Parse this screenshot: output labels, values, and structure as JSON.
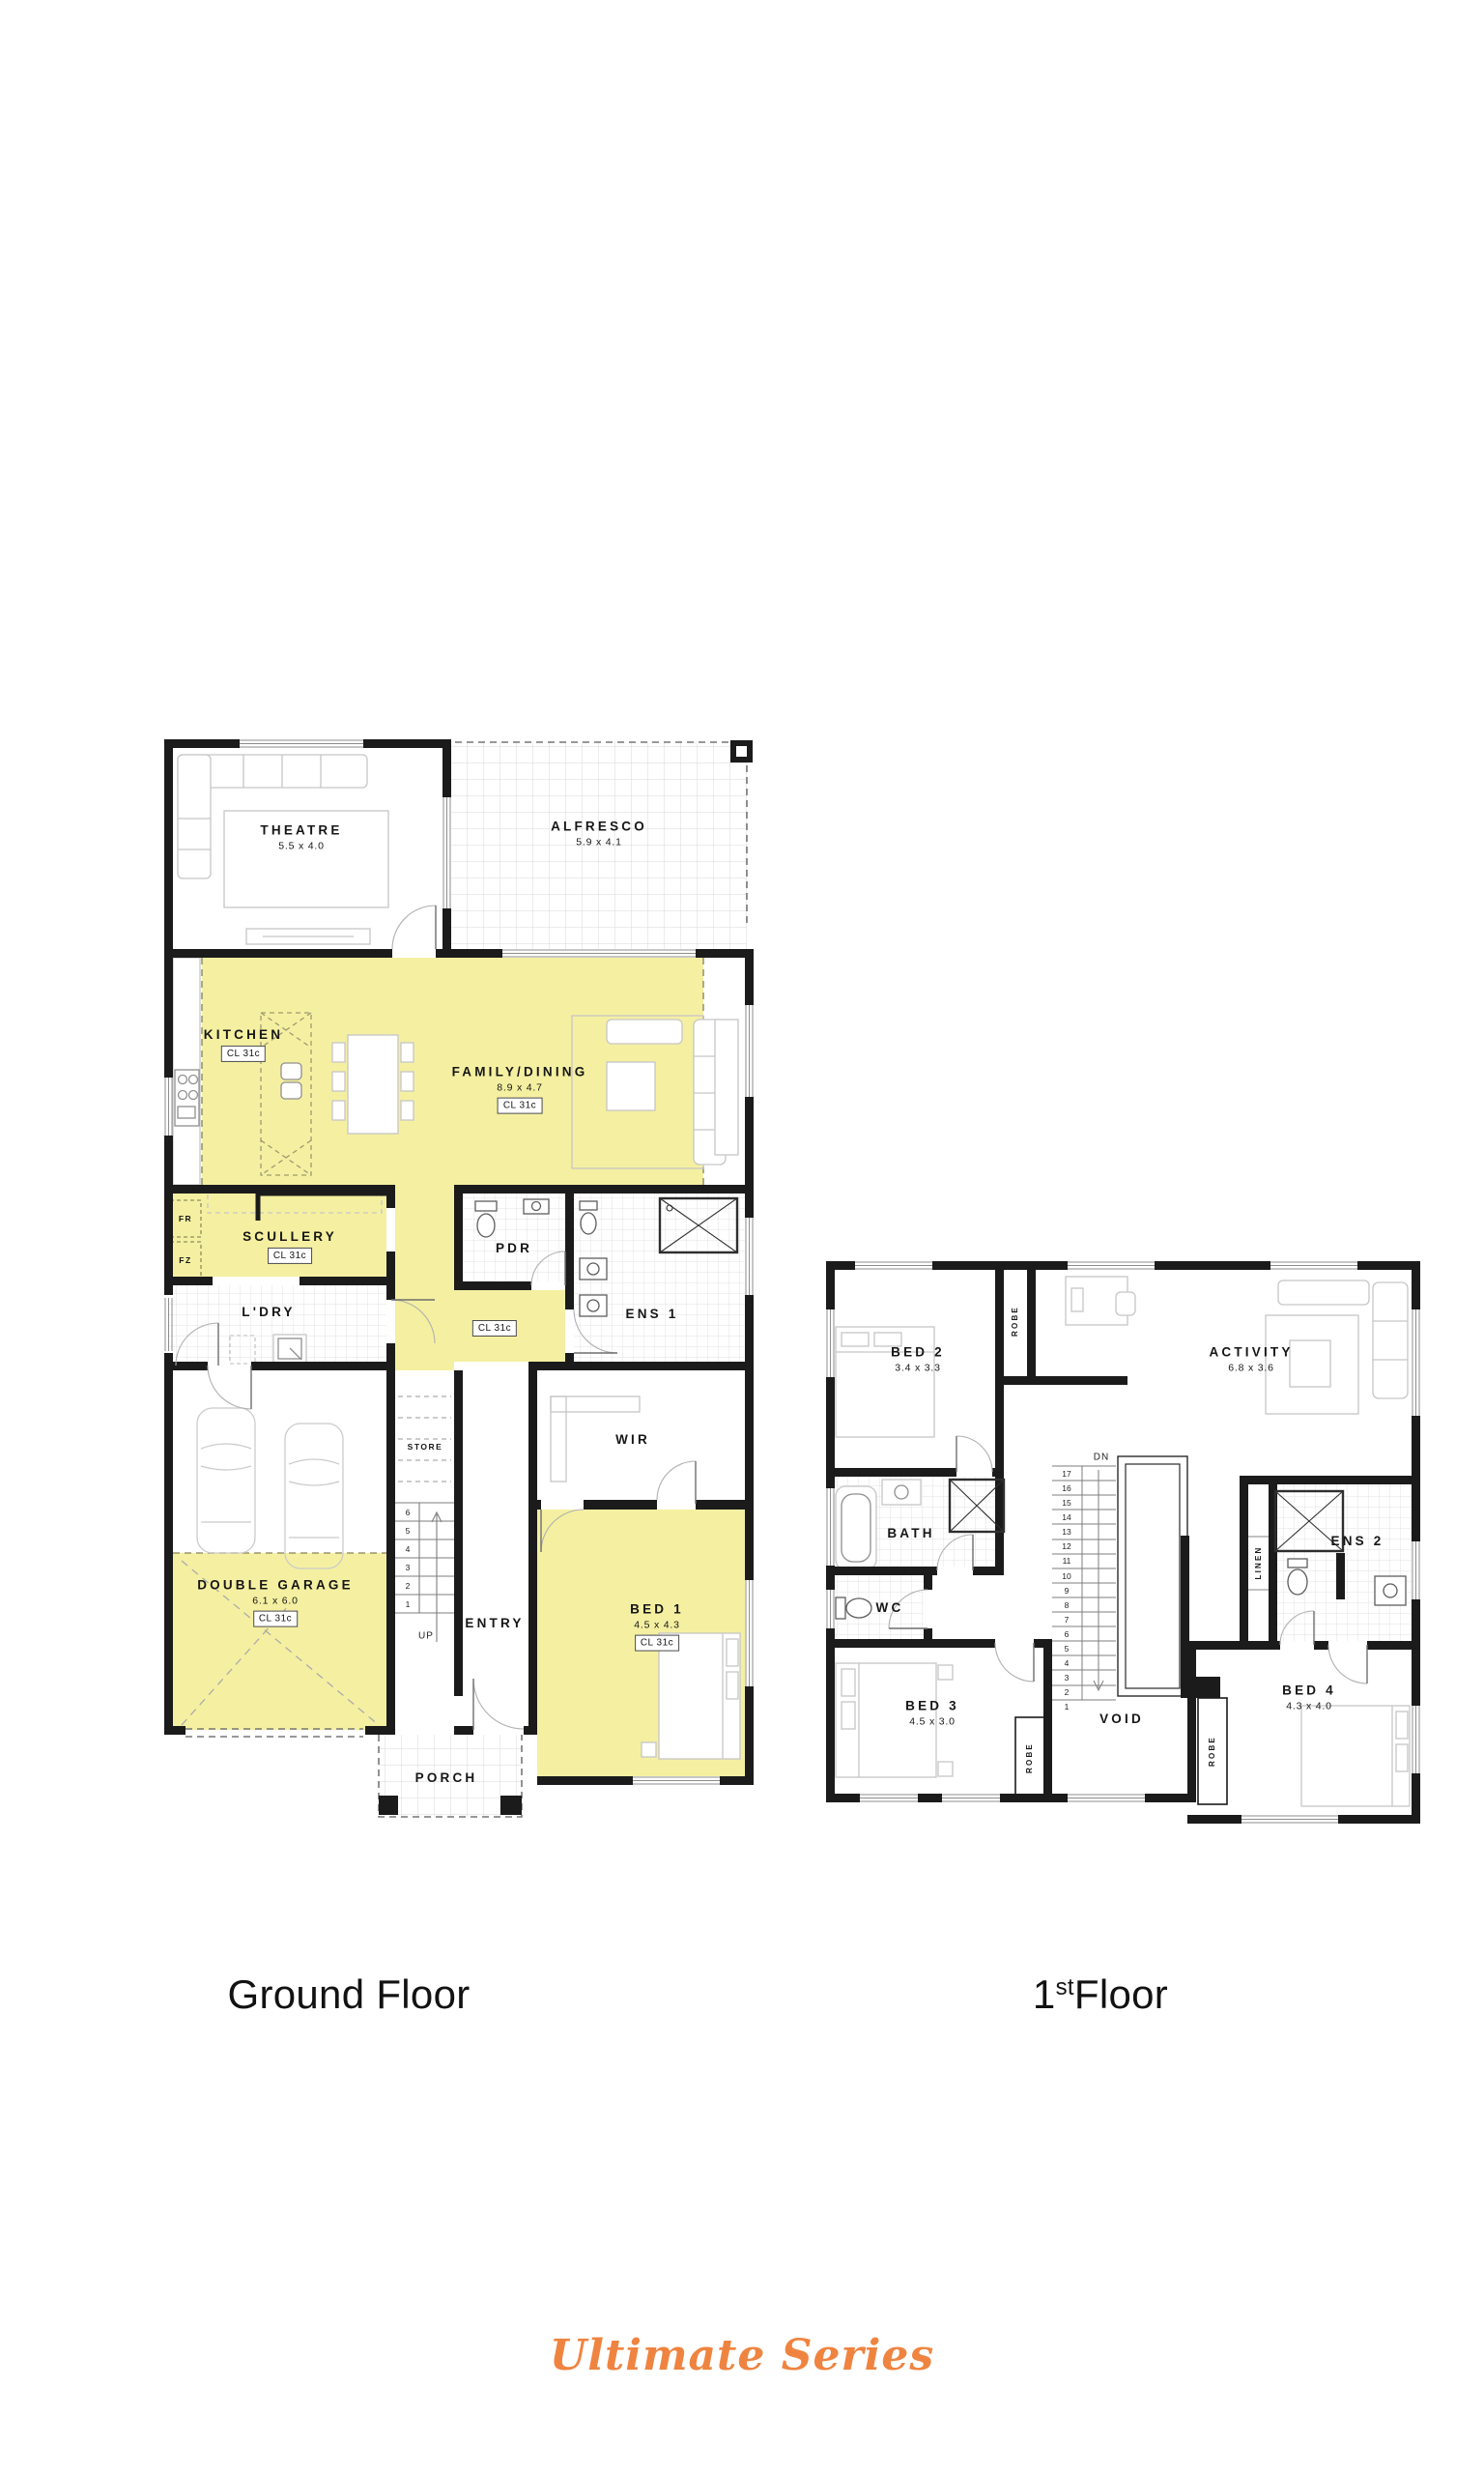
{
  "colors": {
    "highlight": "#F5F0A1",
    "wall": "#1b1b1b",
    "accent": "#EF8440"
  },
  "ground_floor": {
    "caption": "Ground Floor",
    "rooms": {
      "theatre": {
        "name": "THEATRE",
        "dim": "5.5 x 4.0"
      },
      "alfresco": {
        "name": "ALFRESCO",
        "dim": "5.9 x 4.1"
      },
      "kitchen": {
        "name": "KITCHEN",
        "ceiling": "CL 31c"
      },
      "family_dining": {
        "name": "FAMILY/DINING",
        "dim": "8.9 x 4.7",
        "ceiling": "CL 31c"
      },
      "scullery": {
        "name": "SCULLERY",
        "ceiling": "CL 31c"
      },
      "fridge_label": "FR",
      "freezer_label": "FZ",
      "laundry": {
        "name": "L'DRY"
      },
      "hall": {
        "ceiling": "CL 31c"
      },
      "pdr": {
        "name": "PDR"
      },
      "ens1": {
        "name": "ENS 1"
      },
      "wir": {
        "name": "WIR"
      },
      "store": {
        "name": "STORE"
      },
      "garage": {
        "name": "DOUBLE GARAGE",
        "dim": "6.1 x 6.0",
        "ceiling": "CL 31c"
      },
      "entry": {
        "name": "ENTRY"
      },
      "bed1": {
        "name": "BED 1",
        "dim": "4.5 x 4.3",
        "ceiling": "CL 31c"
      },
      "porch": {
        "name": "PORCH"
      }
    },
    "stairs": {
      "label": "UP",
      "treads": [
        "6",
        "5",
        "4",
        "3",
        "2",
        "1"
      ]
    }
  },
  "first_floor": {
    "caption_number": "1",
    "caption_ordinal": "st",
    "caption_word": "Floor",
    "rooms": {
      "bed2": {
        "name": "BED 2",
        "dim": "3.4 x 3.3"
      },
      "bed2_robe": "ROBE",
      "activity": {
        "name": "ACTIVITY",
        "dim": "6.8 x 3.6"
      },
      "bath": {
        "name": "BATH"
      },
      "wc": {
        "name": "WC"
      },
      "linen": "LINEN",
      "ens2": {
        "name": "ENS 2"
      },
      "bed3": {
        "name": "BED 3",
        "dim": "4.5 x 3.0"
      },
      "bed3_robe": "ROBE",
      "void": {
        "name": "VOID"
      },
      "bed4": {
        "name": "BED 4",
        "dim": "4.3 x 4.0"
      },
      "bed4_robe": "ROBE"
    },
    "stairs": {
      "label": "DN",
      "treads": [
        "17",
        "16",
        "15",
        "14",
        "13",
        "12",
        "11",
        "10",
        "9",
        "8",
        "7",
        "6",
        "5",
        "4",
        "3",
        "2",
        "1"
      ]
    }
  },
  "footer": {
    "series": "Ultimate Series"
  }
}
